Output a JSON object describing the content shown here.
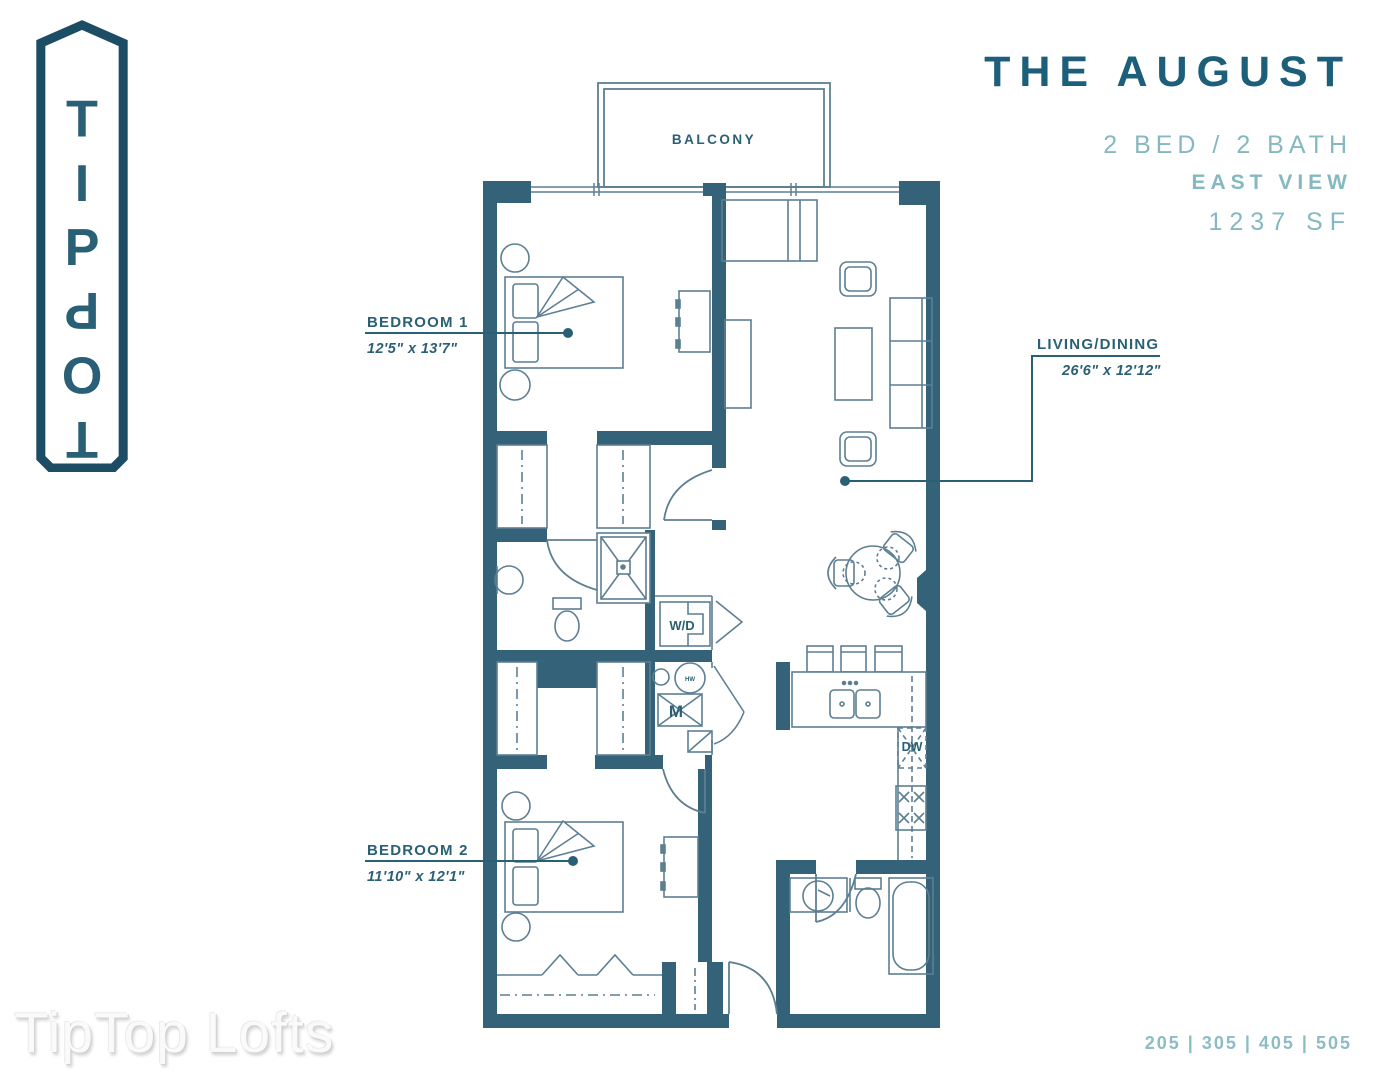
{
  "logo": {
    "letters": [
      {
        "ch": "T",
        "color": "#4e91aa",
        "flip": false
      },
      {
        "ch": "I",
        "color": "#1c4961",
        "flip": false
      },
      {
        "ch": "P",
        "color": "#4e91aa",
        "flip": false
      },
      {
        "ch": "P",
        "color": "#1c4961",
        "flip": true
      },
      {
        "ch": "O",
        "color": "#2e7089",
        "flip": true
      },
      {
        "ch": "T",
        "color": "#2e7089",
        "flip": true
      }
    ]
  },
  "title": {
    "name": "THE AUGUST",
    "spec": "2 BED / 2 BATH",
    "view": "EAST VIEW",
    "area": "1237 SF"
  },
  "plan": {
    "balcony": "BALCONY",
    "bedroom1": {
      "label": "BEDROOM 1",
      "dims": "12'5\" x 13'7\""
    },
    "bedroom2": {
      "label": "BEDROOM 2",
      "dims": "11'10\" x 12'1\""
    },
    "living": {
      "label": "LIVING/DINING",
      "dims": "26'6\" x 12'12\""
    },
    "wd": "W/D",
    "m": "M",
    "dw": "DW",
    "hw": "HW"
  },
  "footer": {
    "watermark": "TipTop Lofts",
    "units": "205 | 305 | 405 | 505"
  },
  "colors": {
    "wall": "#336279",
    "line": "#5d7f92",
    "accent_dark": "#1d5f7b",
    "accent_light": "#85b8c1",
    "label": "#2a6075"
  }
}
